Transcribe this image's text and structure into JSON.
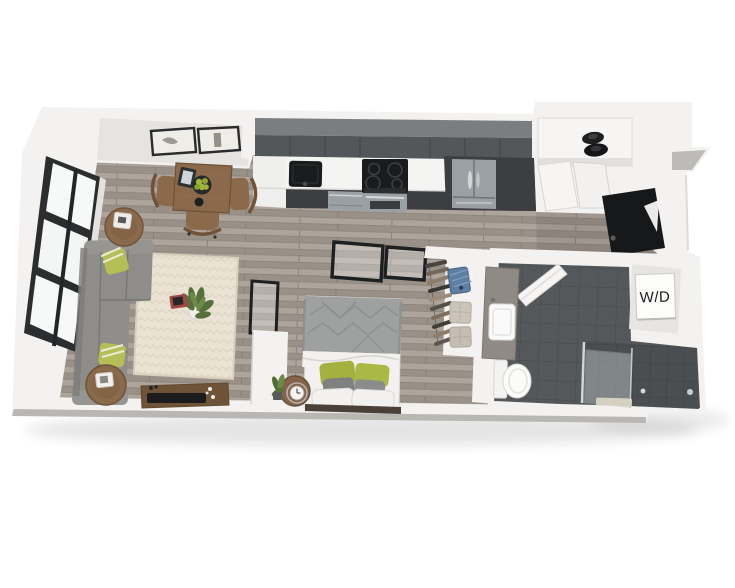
{
  "floorplan": {
    "type": "3d-studio-apartment-floor-plan",
    "labels": {
      "washer_dryer": "W/D"
    },
    "colors": {
      "background": "#ffffff",
      "wall": "#f3f2f0",
      "wall_shade": "#e6e4e1",
      "floor_wood": "#a49b93",
      "tile": "#55585b",
      "tile_shower": "#4b4e51",
      "cabinet": "#54575a",
      "cabinet_base": "#3c3e41",
      "countertop": "#f4f4f3",
      "stainless": "#9aa0a4",
      "appliance_black": "#1a1b1d",
      "sofa": "#8e8d8a",
      "rug": "#eae3d4",
      "wood": "#8a6a4b",
      "wood_dark": "#6f5338",
      "accent_green": "#a4b13c",
      "linen": "#f2f1ef",
      "bed_gray": "#9fa0a0",
      "door_black": "#17181a",
      "glass_frame": "#1e1f20",
      "label_text": "#1c1c1c"
    }
  }
}
